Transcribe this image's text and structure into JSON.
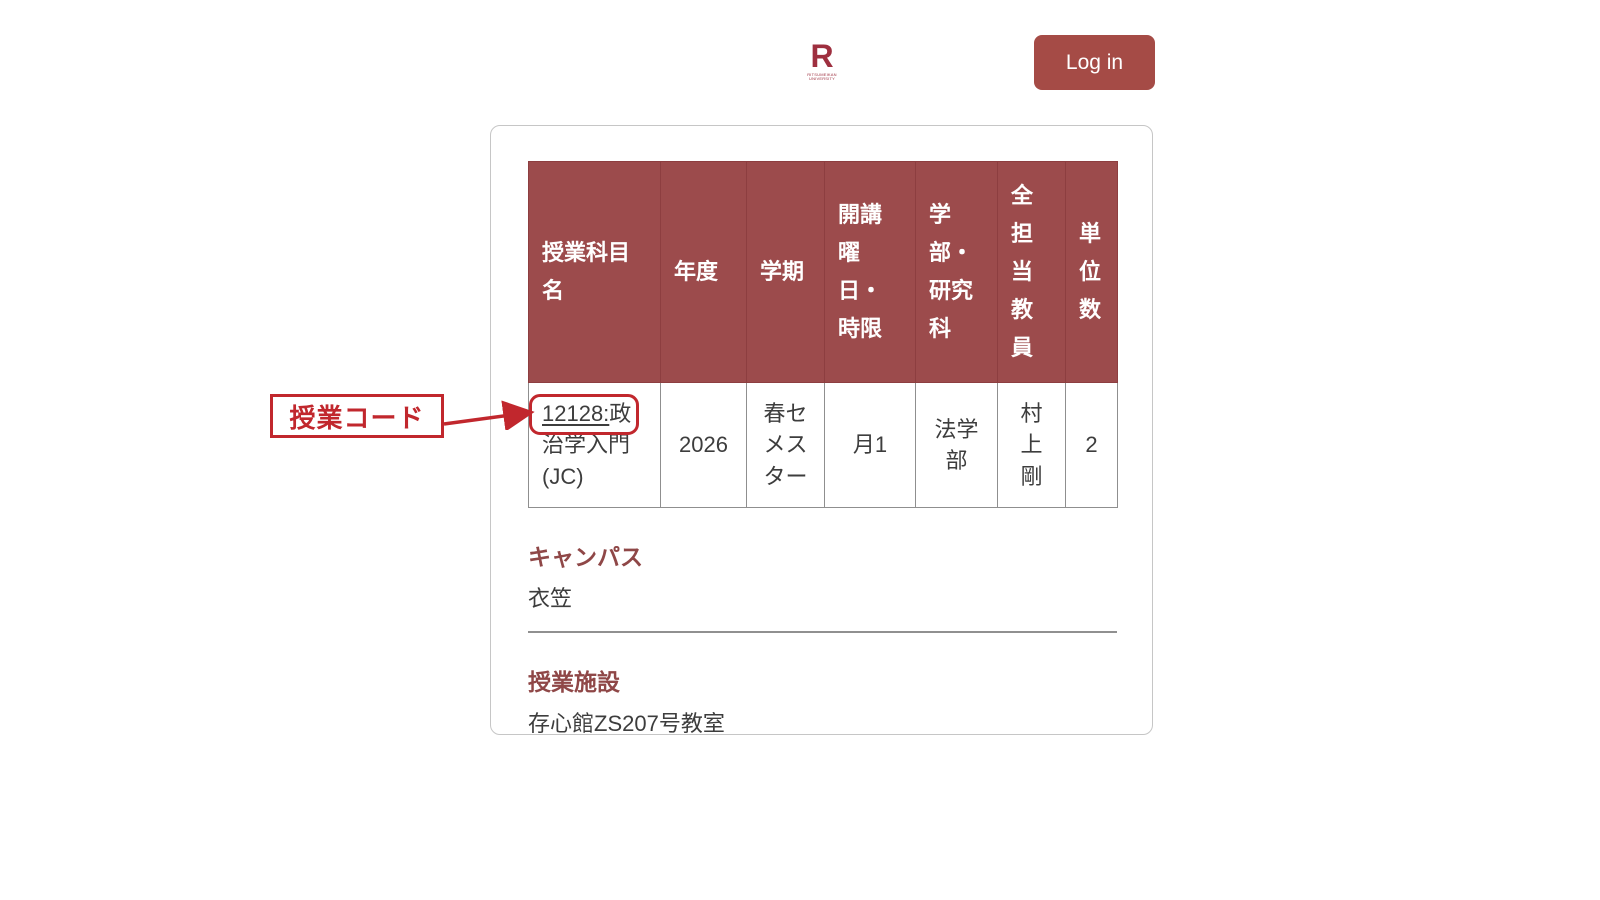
{
  "header": {
    "logo_letter": "R",
    "logo_subtext": "RITSUMEIKAN UNIVERSITY",
    "login_label": "Log in"
  },
  "annotation": {
    "label": "授業コード"
  },
  "course_table": {
    "columns": [
      "授業科目名",
      "年度",
      "学期",
      "開講曜日・時限",
      "学部・研究科",
      "全担当教員",
      "単位数"
    ],
    "row": {
      "course_code": "12128:",
      "course_title": "政治学入門 (JC)",
      "year": "2026",
      "semester": "春セメスター",
      "day_period": "月1",
      "faculty": "法学部",
      "instructors": "村上剛",
      "credits": "2"
    }
  },
  "details": [
    {
      "heading": "キャンパス",
      "value": "衣笠"
    },
    {
      "heading": "授業施設",
      "value": "存心館ZS207号教室"
    }
  ],
  "colors": {
    "table_header_bg": "#9c4b4c",
    "table_header_border": "#8d3e40",
    "login_button_bg": "#a54b46",
    "annotation_red": "#c1272d",
    "section_heading": "#8f4747",
    "body_text": "#3d3d3d",
    "divider": "#909090",
    "card_border": "#c6c6c6"
  }
}
